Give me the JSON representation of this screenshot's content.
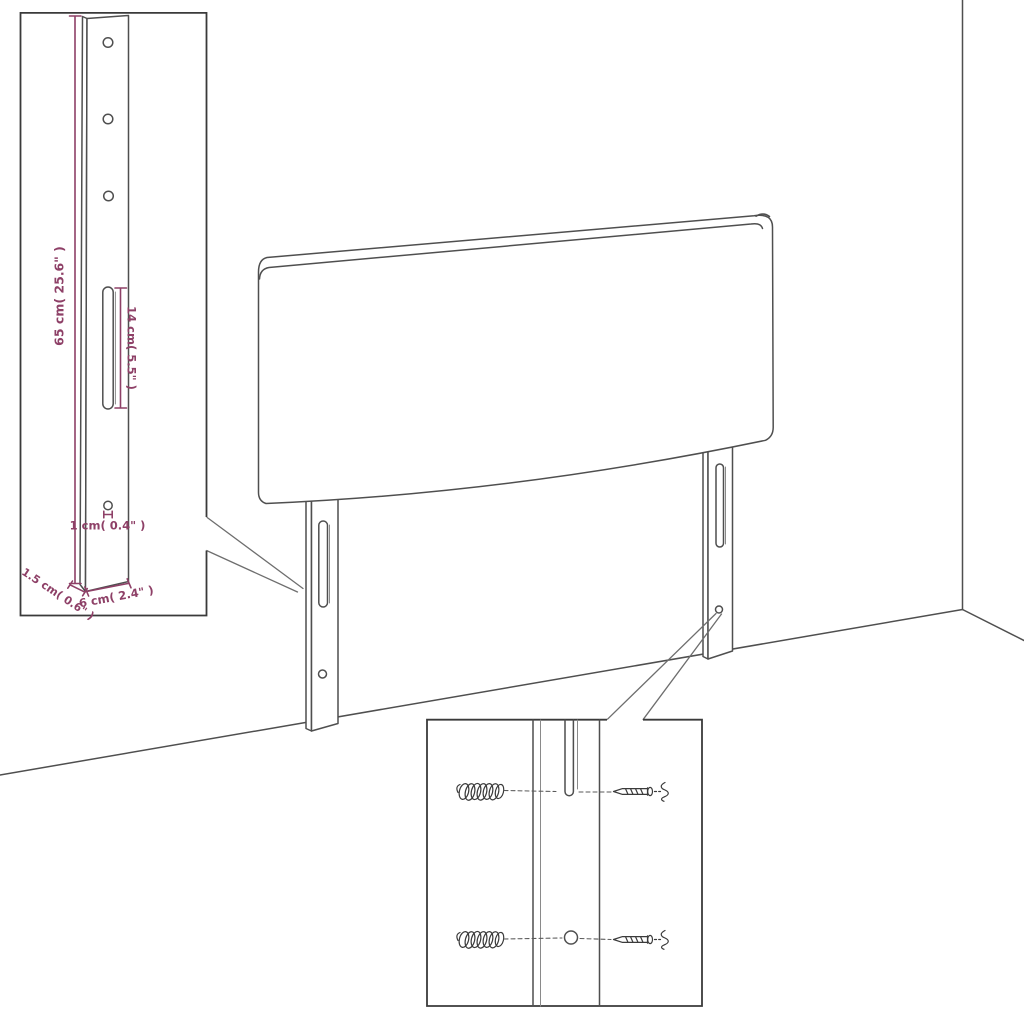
{
  "page": {
    "background": "#ffffff",
    "description": "Product dimension diagram of an upholstered headboard with two slotted mounting legs standing against a room corner, with a magnified leg detail (left) and a magnified wall-mounting hardware detail (bottom)"
  },
  "diagram": {
    "colors": {
      "outline": "#4f4f4f",
      "detail_box_border": "#3a3a3a",
      "dimension": "#8e4067",
      "background": "#ffffff"
    },
    "labels": {
      "leg_height": "65 cm( 25.6\" )",
      "slot_length": "14 cm( 5.5\" )",
      "hole_diameter": "1 cm( 0.4\" )",
      "leg_depth": "1.5 cm( 0.6\" )",
      "leg_width": "6 cm( 2.4\" )"
    },
    "parts": {
      "panel": "headboard panel with rolled top edge",
      "legs": "two mounting legs, each with one vertical slot and one round hole",
      "leg_detail": "enlarged leg with three holes, long slot, small hole",
      "hardware_detail": "two wall plugs and two screws aligned with leg slot and hole",
      "room": "wall corner and floor lines"
    }
  }
}
